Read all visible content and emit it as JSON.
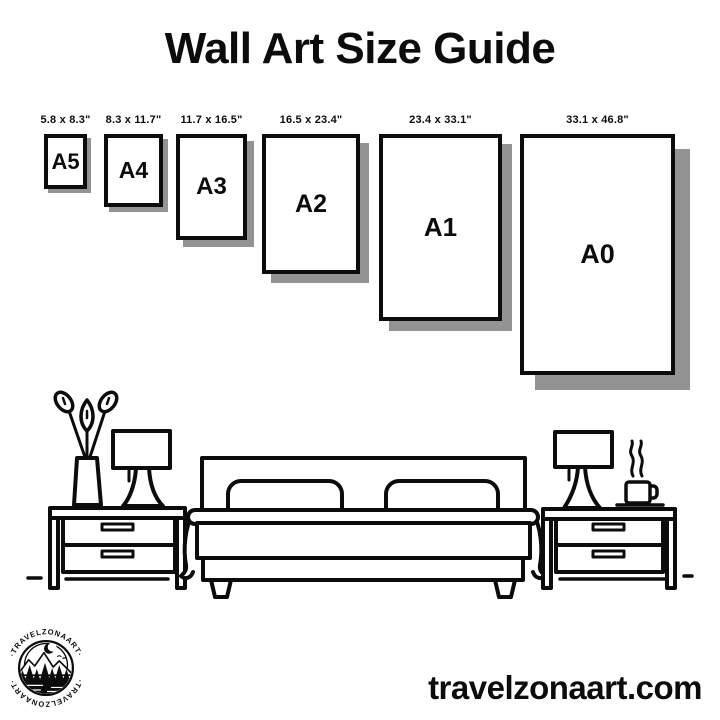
{
  "title": "Wall Art Size Guide",
  "sizes": [
    {
      "name": "A5",
      "dimensions": "5.8 x 8.3\""
    },
    {
      "name": "A4",
      "dimensions": "8.3 x 11.7\""
    },
    {
      "name": "A3",
      "dimensions": "11.7 x 16.5\""
    },
    {
      "name": "A2",
      "dimensions": "16.5 x 23.4\""
    },
    {
      "name": "A1",
      "dimensions": "23.4 x 33.1\""
    },
    {
      "name": "A0",
      "dimensions": "33.1 x 46.8\""
    }
  ],
  "logo": {
    "brand_top": "·TRAVELZONAART·",
    "brand_bottom": "·TRAVELZONAART·"
  },
  "footer": {
    "website": "travelzonaart.com"
  },
  "illustration": {
    "icons": [
      "plant-vase-icon",
      "table-lamp-icon",
      "nightstand-icon",
      "double-bed-icon",
      "pillow-icon",
      "coffee-cup-icon",
      "floor-line"
    ]
  },
  "colors": {
    "ink": "#0c0c0c",
    "shadow": "#939393",
    "background": "#ffffff"
  }
}
